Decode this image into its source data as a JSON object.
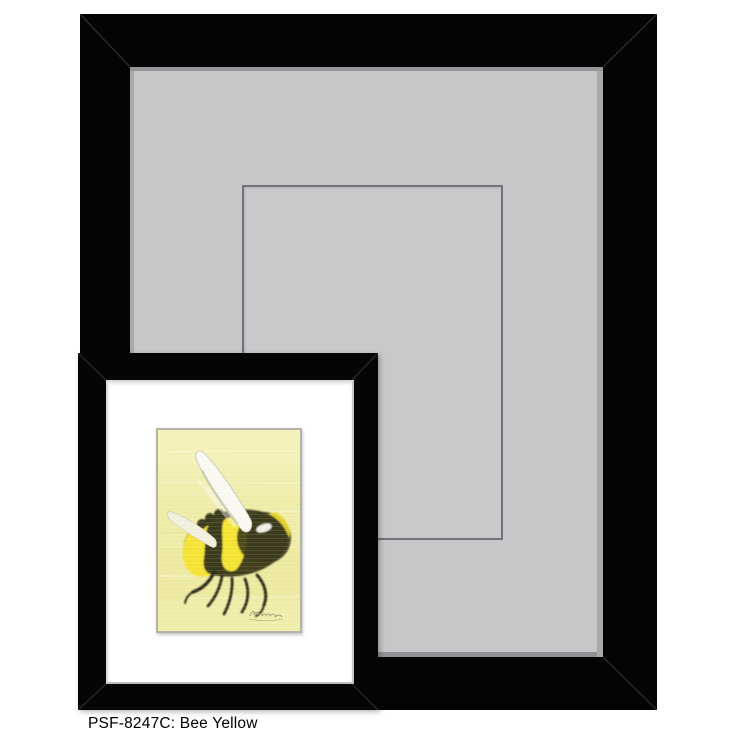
{
  "caption": "PSF-8247C: Bee Yellow",
  "product": {
    "sku": "PSF-8247C",
    "name": "Bee Yellow"
  },
  "artwork": {
    "subject": "bumblebee painting on pale yellow background",
    "signature": "illegible cursive artist signature"
  },
  "colors": {
    "page_background": "#ffffff",
    "frame_black": "#040404",
    "large_mat_gray": "#c7c7c9",
    "mat_bevel_shadow": "#96969a",
    "mat_opening_line": "#737377",
    "small_mat_white": "#ffffff",
    "small_frame_lip": "#dadada",
    "painting_background": "#f0eda8",
    "bee_yellow": "#f5e32e",
    "bee_dark_olive": "#42411f",
    "wing_white": "#fbfaf2",
    "caption_text": "#000000"
  }
}
